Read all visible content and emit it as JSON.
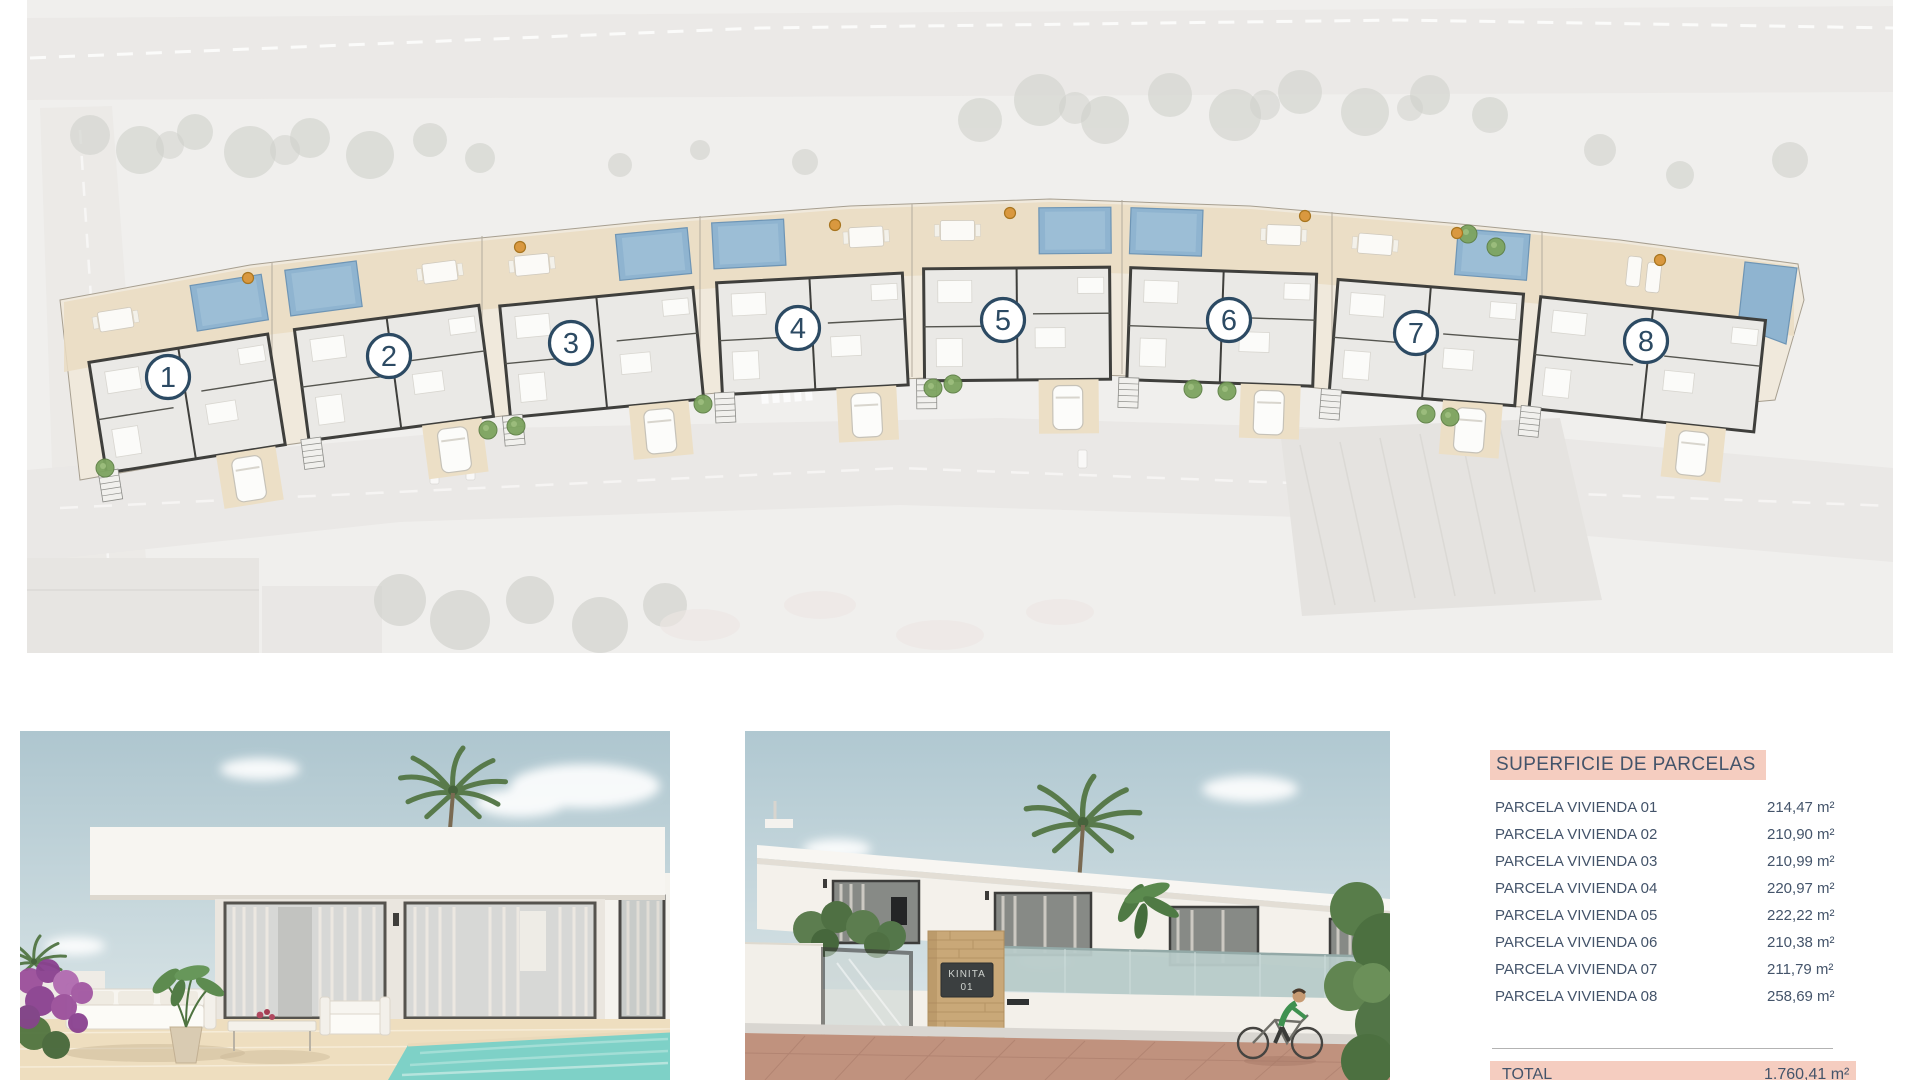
{
  "page": {
    "background": "#ffffff"
  },
  "site_plan": {
    "label": "Aerial site plan with 8 numbered villa parcels",
    "plots": [
      {
        "number": "1",
        "center_x": 168,
        "top_y": 283,
        "rotation": -9,
        "width": 205,
        "circle_x": 168,
        "circle_y": 377,
        "pool_side": 1
      },
      {
        "number": "2",
        "center_x": 378,
        "top_y": 252,
        "rotation": -7.5,
        "width": 210,
        "circle_x": 389,
        "circle_y": 356,
        "pool_side": -1
      },
      {
        "number": "3",
        "center_x": 590,
        "top_y": 231,
        "rotation": -5.5,
        "width": 218,
        "circle_x": 571,
        "circle_y": 343,
        "pool_side": 1
      },
      {
        "number": "4",
        "center_x": 806,
        "top_y": 212,
        "rotation": -3,
        "width": 210,
        "circle_x": 798,
        "circle_y": 328,
        "pool_side": -1
      },
      {
        "number": "5",
        "center_x": 1016,
        "top_y": 202,
        "rotation": -0.5,
        "width": 210,
        "circle_x": 1003,
        "circle_y": 320,
        "pool_side": 1
      },
      {
        "number": "6",
        "center_x": 1226,
        "top_y": 205,
        "rotation": 2,
        "width": 210,
        "circle_x": 1229,
        "circle_y": 320,
        "pool_side": -1
      },
      {
        "number": "7",
        "center_x": 1436,
        "top_y": 221,
        "rotation": 4.5,
        "width": 210,
        "circle_x": 1416,
        "circle_y": 333,
        "pool_side": 1
      },
      {
        "number": "8",
        "center_x": 1660,
        "top_y": 243,
        "rotation": 6,
        "width": 250,
        "circle_x": 1646,
        "circle_y": 341,
        "pool_side": 0
      }
    ],
    "trees": [
      [
        105,
        468
      ],
      [
        488,
        430
      ],
      [
        516,
        426
      ],
      [
        703,
        404
      ],
      [
        933,
        388
      ],
      [
        953,
        384
      ],
      [
        1193,
        389
      ],
      [
        1227,
        391
      ],
      [
        1426,
        414
      ],
      [
        1450,
        417
      ],
      [
        1468,
        234
      ],
      [
        1496,
        247
      ]
    ],
    "orange_markers": [
      [
        248,
        278
      ],
      [
        520,
        247
      ],
      [
        835,
        225
      ],
      [
        1010,
        213
      ],
      [
        1305,
        216
      ],
      [
        1457,
        233
      ],
      [
        1660,
        260
      ]
    ],
    "colors": {
      "pool": "#8fb4d0",
      "terrace": "#eadcc2",
      "parcel": "#f0e9dc",
      "wall": "#3f3f3c",
      "badge": "#2c4a63",
      "tree": "#7da45f",
      "orange": "#d9983f"
    }
  },
  "renders": [
    {
      "name": "villa terrace with pool render"
    },
    {
      "name": "villa street entrance render",
      "sign_line1": "KINITA",
      "sign_line2": "01"
    }
  ],
  "table": {
    "title": "SUPERFICIE DE PARCELAS",
    "rows": [
      {
        "label": "PARCELA VIVIENDA 01",
        "value": "214,47 m²"
      },
      {
        "label": "PARCELA VIVIENDA 02",
        "value": "210,90 m²"
      },
      {
        "label": "PARCELA VIVIENDA 03",
        "value": "210,99 m²"
      },
      {
        "label": "PARCELA VIVIENDA 04",
        "value": "220,97 m²"
      },
      {
        "label": "PARCELA VIVIENDA 05",
        "value": "222,22 m²"
      },
      {
        "label": "PARCELA VIVIENDA 06",
        "value": "210,38 m²"
      },
      {
        "label": "PARCELA VIVIENDA 07",
        "value": "211,79 m²"
      },
      {
        "label": "PARCELA VIVIENDA 08",
        "value": "258,69 m²"
      }
    ],
    "total_label": "TOTAL",
    "total_value": "1.760,41 m²",
    "colors": {
      "highlight": "#f5cdc0",
      "text": "#44546a",
      "separator": "#b3b3b3"
    }
  }
}
